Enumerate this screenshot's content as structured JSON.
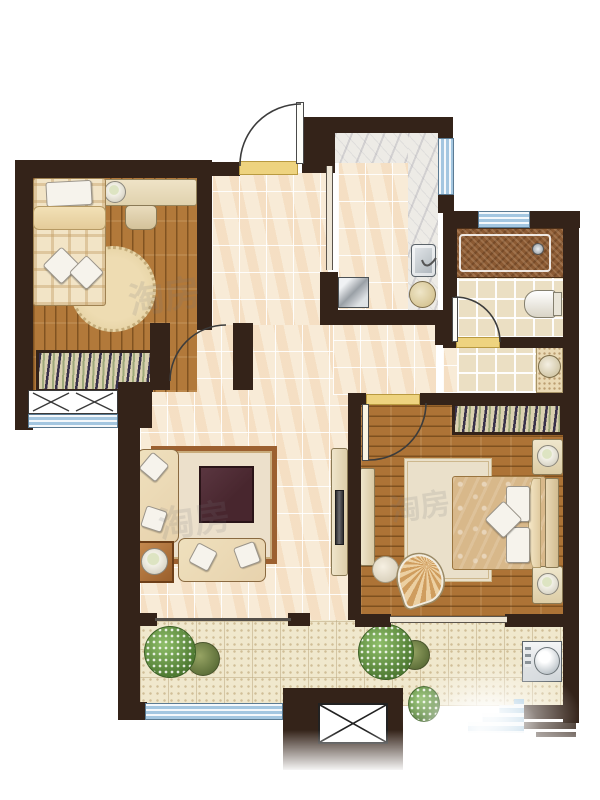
{
  "title": "two-bedroom-apartment-floor-plan",
  "watermark": {
    "text1": "淘房",
    "text2": "淘房",
    "text3": "淘房"
  },
  "palette": {
    "wall": "#342319",
    "tile": "#f8ebd7",
    "wood": "#b2793a",
    "marble": "#edebe6",
    "bathtile": "#ebdfc3",
    "balconytile": "#f0e8cd",
    "blue": "#a3c6e0",
    "yellow": "#eed37f",
    "tub": "#8b5a33",
    "hatch": "#d9d0b0",
    "hatchline": "#38304a",
    "rug": "#ece0cb",
    "rugborder": "#9c6030",
    "sofa": "#e7d2ad",
    "cushion": "#f6f3ec",
    "tabledark": "#48262e",
    "speckle": "#ead9b4",
    "green": "#6b9b49"
  },
  "rooms": [
    {
      "id": "bedroom-secondary",
      "floor": "wood-plank"
    },
    {
      "id": "entry-hall",
      "floor": "ceramic-tile"
    },
    {
      "id": "kitchen",
      "floor": "tile-with-marble-counter"
    },
    {
      "id": "bathroom-toilet",
      "floor": "bath-tile"
    },
    {
      "id": "washroom",
      "floor": "bath-tile"
    },
    {
      "id": "living-room",
      "floor": "ceramic-tile"
    },
    {
      "id": "bedroom-master",
      "floor": "wood-plank"
    },
    {
      "id": "balcony-left",
      "floor": "speckled-tile"
    },
    {
      "id": "balcony-right",
      "floor": "speckled-tile"
    },
    {
      "id": "elevator-shaft",
      "floor": "none"
    }
  ],
  "furniture": [
    "single-bed",
    "desk",
    "desk-lamp",
    "desk-chair",
    "round-rug",
    "wardrobe",
    "entry-door",
    "interior-doors",
    "sliding-doors",
    "bay-window-seat",
    "sofa-set",
    "cushions",
    "coffee-table",
    "area-rug",
    "lamp-side-table",
    "tv-cabinet",
    "kitchen-counter",
    "kitchen-sink",
    "round-basin",
    "cooktop",
    "bathtub",
    "toilet",
    "wash-basin",
    "double-bed",
    "pillows",
    "nightstands",
    "bedside-lamps",
    "dresser",
    "armchair",
    "ottoman",
    "bedroom-rug",
    "washing-machine",
    "plants",
    "windows",
    "elevator-x-symbol"
  ]
}
